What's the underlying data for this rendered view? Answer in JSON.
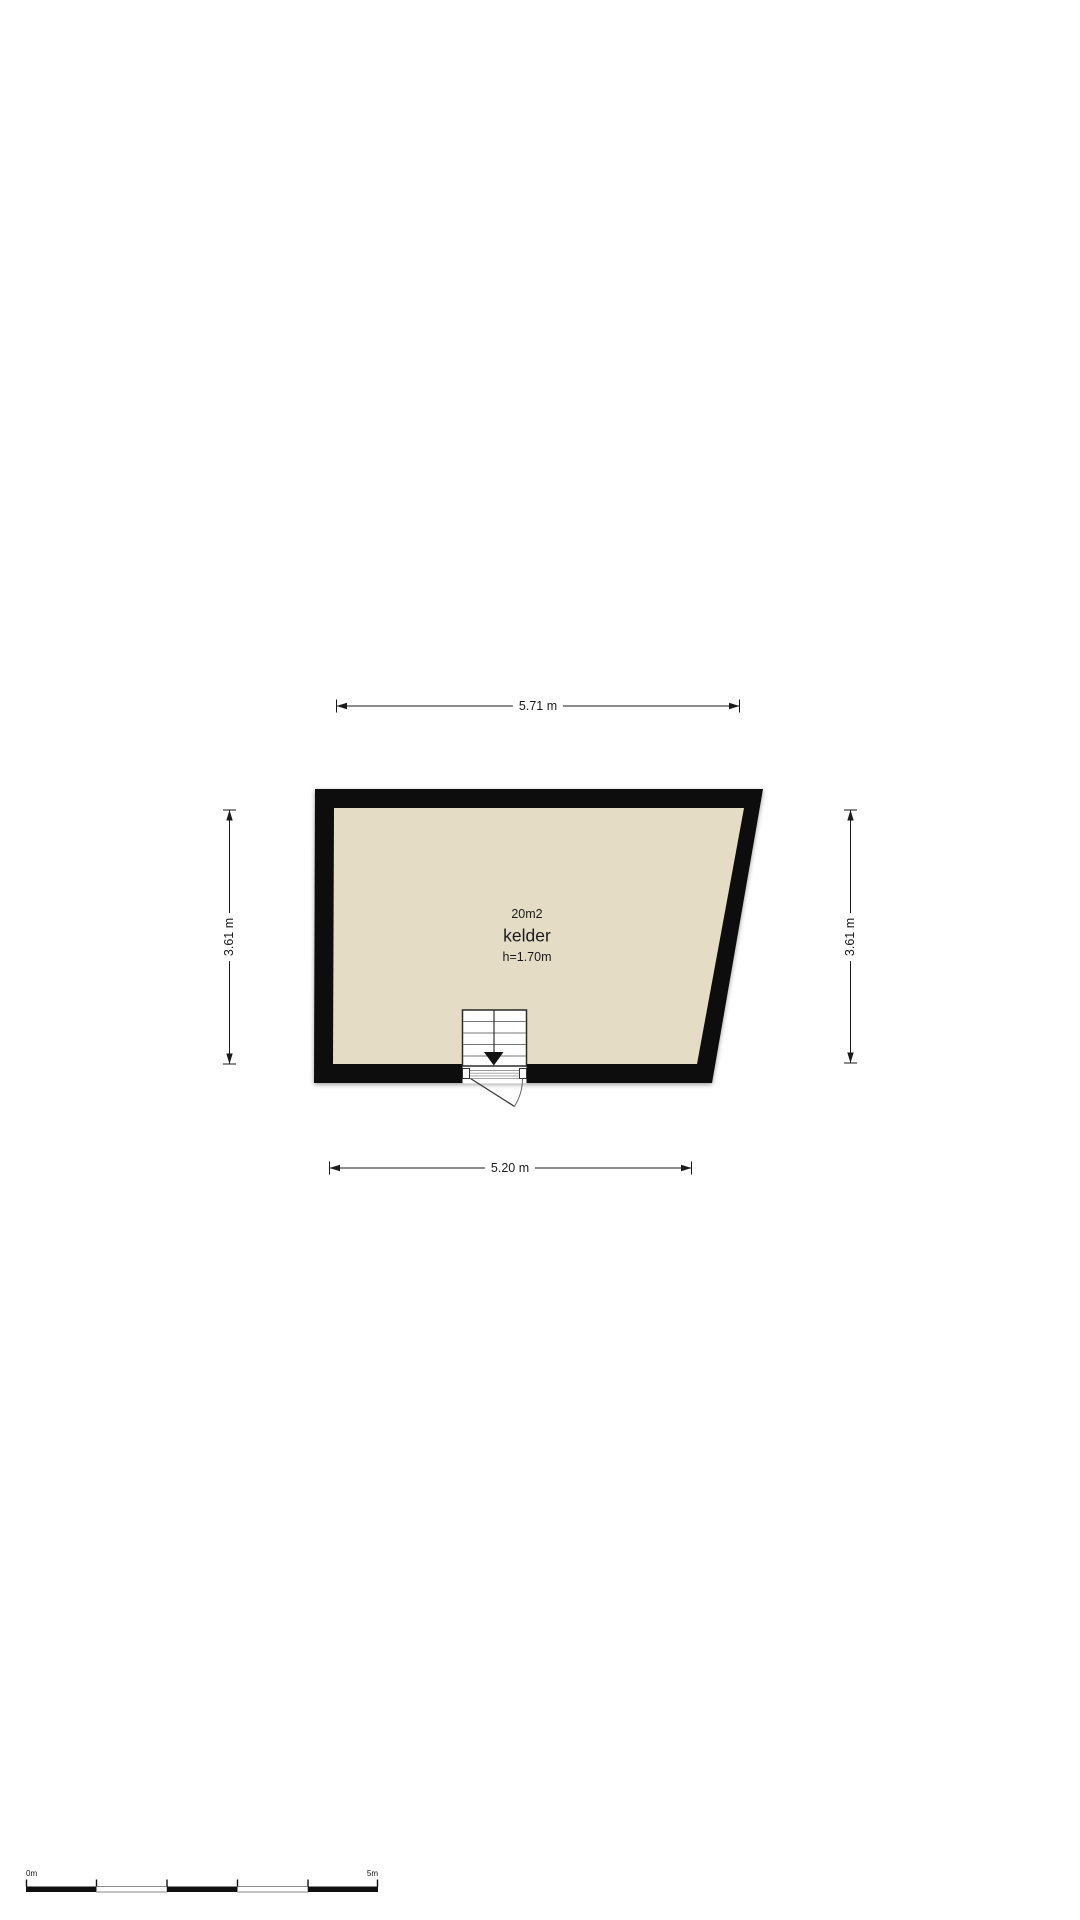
{
  "colors": {
    "wall": "#0a0a0a",
    "floor": "#e4dcc4",
    "line": "#1a1a1a",
    "stair_line": "#777777",
    "door_line": "#3a3a3a",
    "scale_gray": "#8a8a8a"
  },
  "room": {
    "area": "20m2",
    "name": "kelder",
    "ceiling_height": "h=1.70m"
  },
  "dimensions": {
    "top": "5.71 m",
    "bottom": "5.20 m",
    "left": "3.61 m",
    "right": "3.61 m"
  },
  "scale_bar": {
    "start": "0m",
    "end": "5m"
  }
}
